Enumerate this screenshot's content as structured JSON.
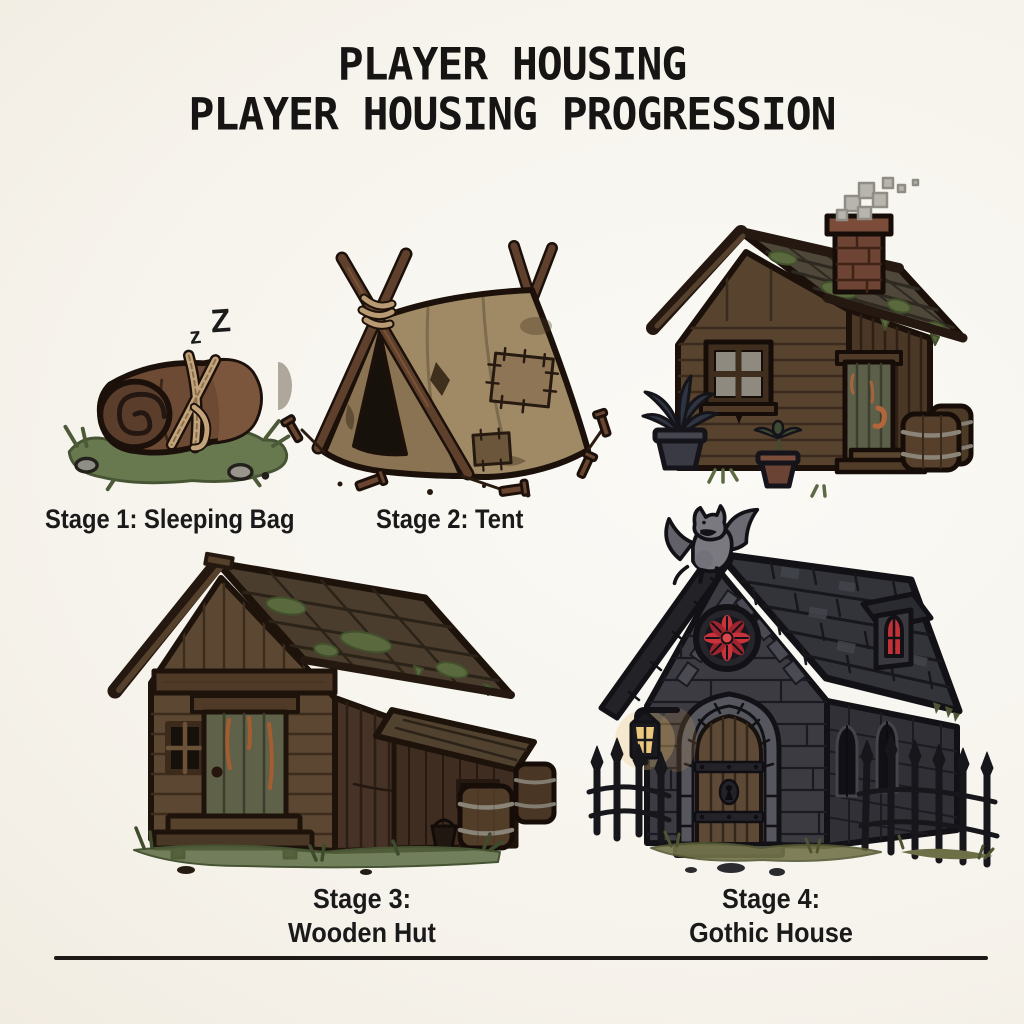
{
  "title": {
    "line1": "PLAYER HOUSING",
    "line2": "PLAYER HOUSING PROGRESSION"
  },
  "stages": [
    {
      "name": "sleeping-bag",
      "label": "Stage 1: Sleeping Bag",
      "zz_small": "z",
      "zz_big": "Z",
      "depicts": "rolled brown bedroll tied with rope on grass with small rocks"
    },
    {
      "name": "tent",
      "label": "Stage 2: Tent",
      "depicts": "patched tattered canvas tent on crossed wooden poles with ground stakes"
    },
    {
      "name": "wooden-hut",
      "label_line1": "Stage 3:",
      "label_line2": "Wooden Hut",
      "depicts": "weathered plank hut with mossy roof, lean-to annex, barrels and front steps"
    },
    {
      "name": "gothic-house",
      "label_line1": "Stage 4:",
      "label_line2": "Gothic House",
      "depicts": "dark stone house with gargoyle, red rose window, arched door, lantern and iron fence"
    }
  ],
  "unlabeled_illustrations": [
    {
      "name": "wooden-cabin",
      "depicts": "small wooden cabin with smoking brick chimney, window, green door, barrels and potted plants"
    }
  ],
  "palette": {
    "paper": "#f6f3ec",
    "ink_outline": "#1b100a",
    "wood": "#5c4733",
    "canvas": "#a08a66",
    "stone": "#3c3b42",
    "slate_roof": "#33343a",
    "red_glass": "#c8333b",
    "lantern_glow": "#ecc87e",
    "moss": "#5a6a3e",
    "grass": "#68784f",
    "smoke": "#b8b5ae"
  }
}
